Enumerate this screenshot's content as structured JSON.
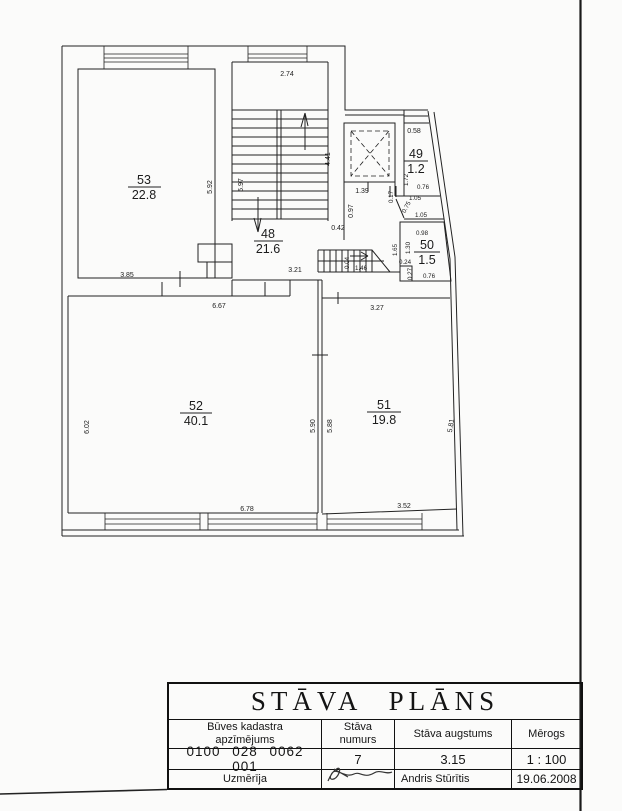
{
  "colors": {
    "ink": "#1a1a1a",
    "paper": "#fbfbfa"
  },
  "plan": {
    "rooms": [
      {
        "number": "53",
        "area": "22.8"
      },
      {
        "number": "48",
        "area": "21.6"
      },
      {
        "number": "49",
        "area": "1.2"
      },
      {
        "number": "50",
        "area": "1.5"
      },
      {
        "number": "52",
        "area": "40.1"
      },
      {
        "number": "51",
        "area": "19.8"
      }
    ],
    "dims": {
      "d274": "2.74",
      "d592": "5.92",
      "d385": "3.85",
      "d597": "5.97",
      "d441": "4.41",
      "d042": "0.42",
      "d321": "3.21",
      "d667": "6.67",
      "d139": "1.39",
      "d017": "0.17",
      "d097": "0.97",
      "d058": "0.58",
      "d172": "1.72",
      "d076a": "0.76",
      "d105a": "1.05",
      "d075": "0.75",
      "d105b": "1.05",
      "d098": "0.98",
      "d130": "1.30",
      "d165": "1.65",
      "d024": "0.24",
      "d027": "0.27",
      "d076b": "0.76",
      "d004": "0.04",
      "d146": "1.46",
      "d602": "6.02",
      "d590": "5.90",
      "d588": "5.88",
      "d581": "5.81",
      "d678": "6.78",
      "d352": "3.52",
      "d327": "3.27"
    }
  },
  "title_block": {
    "title": "STĀVA  PLĀNS",
    "columns": [
      {
        "header": "Būves kadastra apzīmējums",
        "value": "0100 028 0062 001"
      },
      {
        "header": "Stāva numurs",
        "value": "7"
      },
      {
        "header": "Stāva augstums",
        "value": "3.15"
      },
      {
        "header": "Mērogs",
        "value": "1 : 100"
      }
    ],
    "footer": {
      "label": "Uzmērīja",
      "name": "Andris Stūrītis",
      "date": "19.06.2008"
    }
  }
}
